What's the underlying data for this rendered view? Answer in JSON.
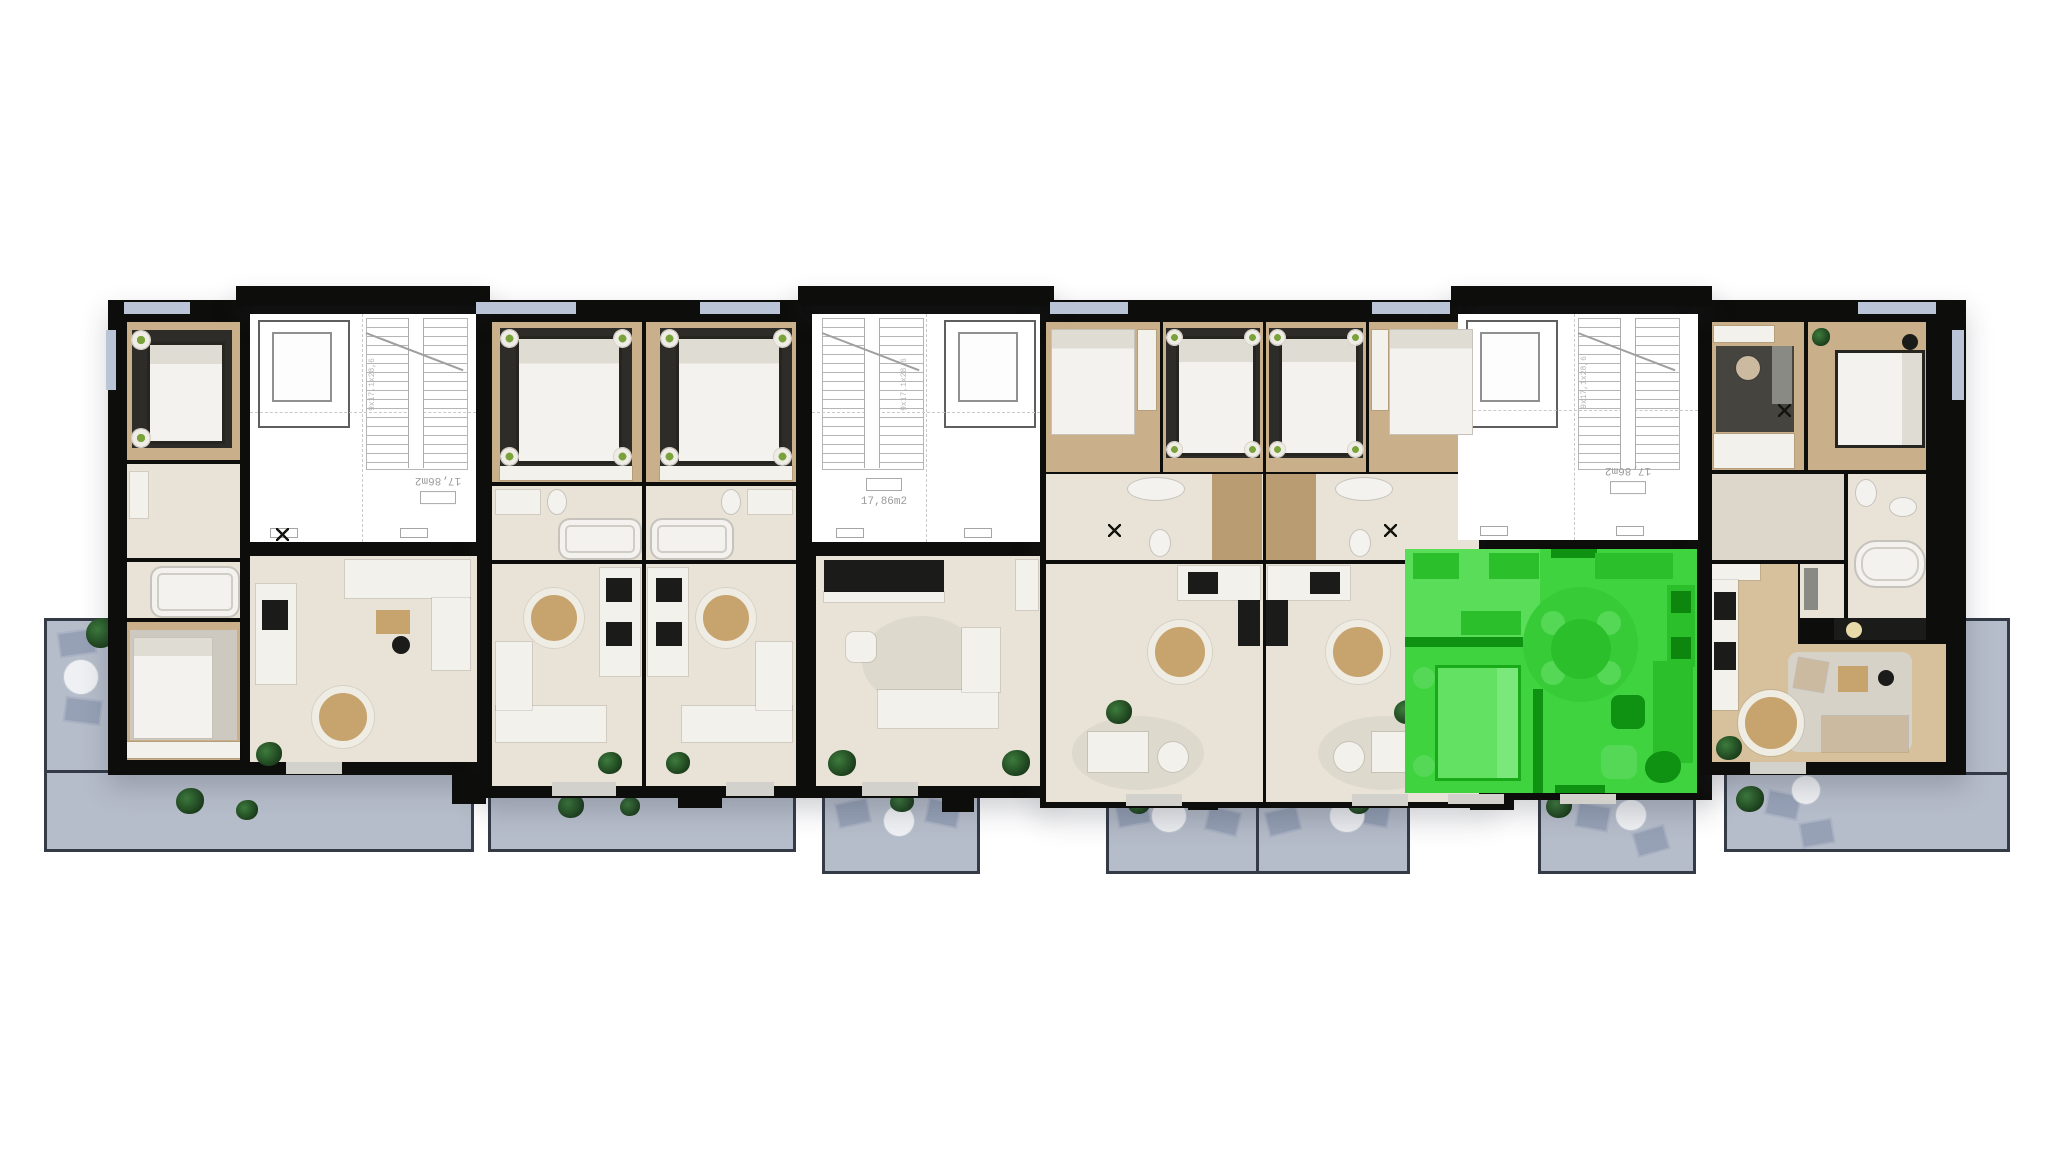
{
  "floorplan": {
    "stairwells": [
      {
        "id": "stairwell-1",
        "area_label": "17,86m2",
        "flight_label": "9x17,1x28,6",
        "label_upside_down": true
      },
      {
        "id": "stairwell-2",
        "area_label": "17,86m2",
        "flight_label": "9x17,1x28,6",
        "label_upside_down": false
      },
      {
        "id": "stairwell-3",
        "area_label": "17,86m2",
        "flight_label": "9x17,1x28,6",
        "label_upside_down": true
      }
    ],
    "units": [
      {
        "id": "apartment-1",
        "highlighted": false
      },
      {
        "id": "apartment-2",
        "highlighted": false
      },
      {
        "id": "apartment-3",
        "highlighted": false
      },
      {
        "id": "apartment-4",
        "highlighted": false
      },
      {
        "id": "apartment-5",
        "highlighted": false
      },
      {
        "id": "apartment-6",
        "highlighted": false
      },
      {
        "id": "apartment-7",
        "highlighted": true
      },
      {
        "id": "apartment-8",
        "highlighted": false
      }
    ],
    "colors": {
      "wall": "#0d0d0b",
      "wood": "#c9b08a",
      "wood-light": "#d6c19c",
      "cream": "#e9e3d7",
      "cream-dim": "#ddd7cb",
      "rug-dark": "#2d2c28",
      "white-furn": "#f3f1ec",
      "balcony": "#b6bdca",
      "balcony-line": "#343b47",
      "highlight": "#3fd43f",
      "highlight-light": "#5ade5a",
      "highlight-mid": "#2cbf2c",
      "highlight-dark": "#0f9212"
    }
  }
}
